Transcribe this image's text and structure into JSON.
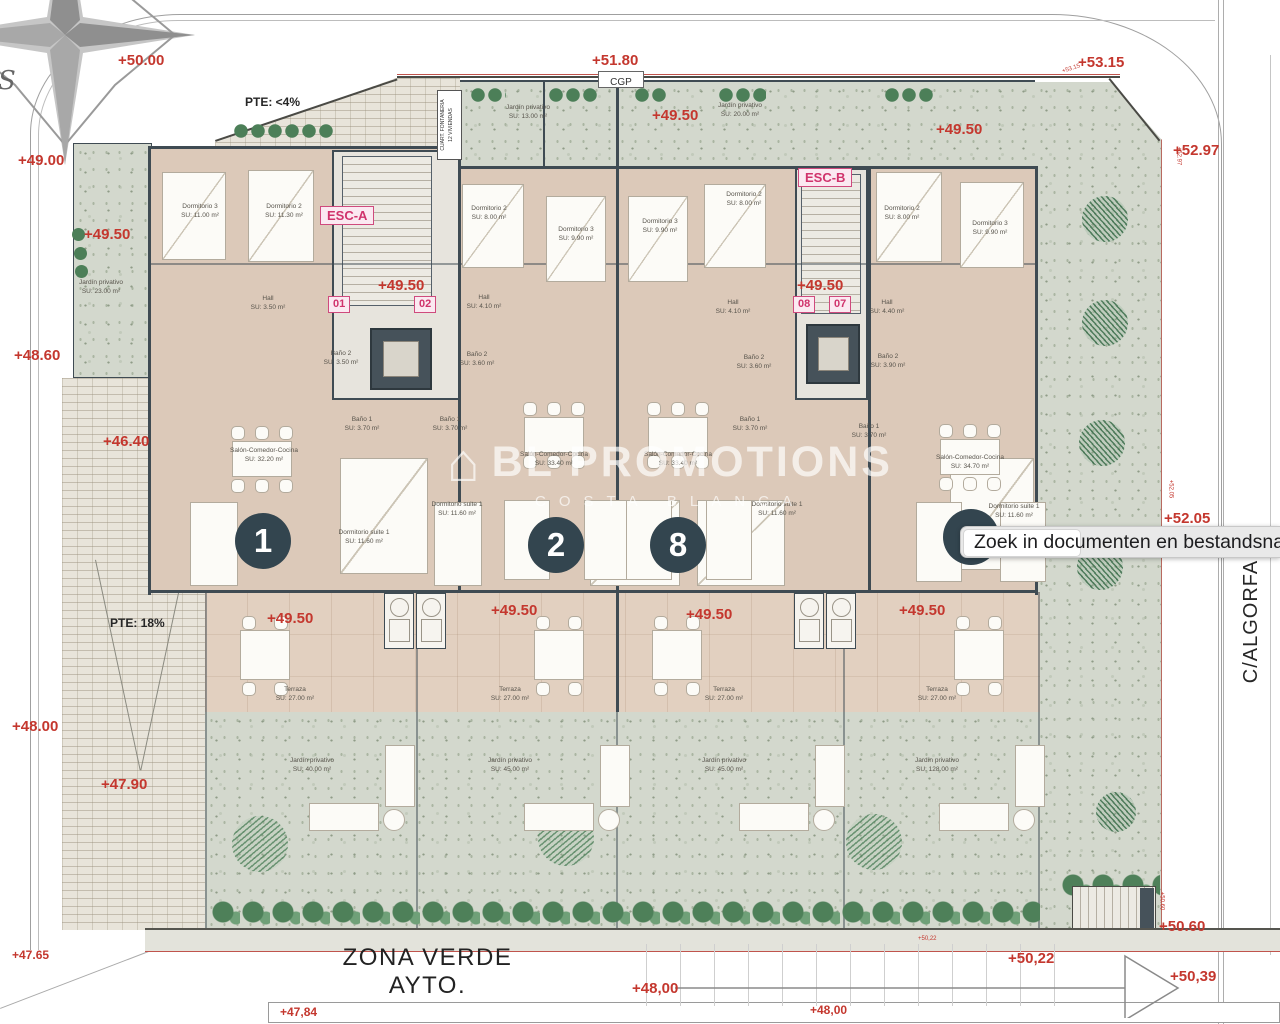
{
  "labels": {
    "compass_s": "S",
    "street": "C/ALGORFA",
    "zona_verde1": "ZONA VERDE",
    "zona_verde2": "AYTO.",
    "cgp": "CGP",
    "pte_top": "PTE: <4%",
    "pte_ramp": "PTE: 18%",
    "fontaneria1": "CUART. FONTANERIA",
    "fontaneria2": "12 VIVIENDAS",
    "esc_a": "ESC-A",
    "esc_b": "ESC-B"
  },
  "unit_tags": [
    "01",
    "02",
    "08",
    "07"
  ],
  "unit_circles": [
    "1",
    "2",
    "8"
  ],
  "watermark": {
    "name": "BL PROMOTIONS",
    "subtitle": "COSTA BLANCA"
  },
  "search": {
    "text": "Zoek in documenten en bestandsnamen"
  },
  "colors": {
    "elevation_red": "#c4372e",
    "magenta": "#d0336c",
    "wall": "#3f4b53",
    "circle": "#33454f"
  },
  "elevations": [
    "+50.00",
    "+51.80",
    "+53.15",
    "+52.97",
    "+49.00",
    "+49.50",
    "+48.60",
    "+46.40",
    "+48.00",
    "+47.90",
    "+47.65",
    "+49.50",
    "+49.50",
    "+49.50",
    "+49.50",
    "+49.50",
    "+49.50",
    "+49.50",
    "+49.50",
    "+49.50",
    "+52.05",
    "+50.60",
    "+50,39",
    "+50,22",
    "+48,00",
    "+48,00",
    "+47,84"
  ],
  "edge_markers": [
    "+53.15",
    "+52.97",
    "+52.05",
    "+50.60",
    "+50,22"
  ],
  "rooms": [
    {
      "name": "Dormitorio 3",
      "area": "SU: 11.00 m²"
    },
    {
      "name": "Dormitorio 2",
      "area": "SU: 11.30 m²"
    },
    {
      "name": "Hall",
      "area": "SU: 3.50 m²"
    },
    {
      "name": "Baño 2",
      "area": "SU: 3.50 m²"
    },
    {
      "name": "Baño 1",
      "area": "SU: 3.70 m²"
    },
    {
      "name": "Salón-Comedor-Cocina",
      "area": "SU: 32.20 m²"
    },
    {
      "name": "Dormitorio suite 1",
      "area": "SU: 11.60 m²"
    },
    {
      "name": "Jardín privativo",
      "area": "SU: 23.00 m²"
    },
    {
      "name": "Dormitorio 2",
      "area": "SU: 8.00 m²"
    },
    {
      "name": "Dormitorio 3",
      "area": "SU: 9.90 m²"
    },
    {
      "name": "Hall",
      "area": "SU: 4.10 m²"
    },
    {
      "name": "Baño 2",
      "area": "SU: 3.60 m²"
    },
    {
      "name": "Baño 1",
      "area": "SU: 3.70 m²"
    },
    {
      "name": "Salón-Comedor-Cocina",
      "area": "SU: 33.40 m²"
    },
    {
      "name": "Dormitorio suite 1",
      "area": "SU: 11.60 m²"
    },
    {
      "name": "Jardín privativo",
      "area": "SU: 13.00 m²"
    },
    {
      "name": "Dormitorio 3",
      "area": "SU: 9.90 m²"
    },
    {
      "name": "Dormitorio 2",
      "area": "SU: 8.00 m²"
    },
    {
      "name": "Hall",
      "area": "SU: 4.10 m²"
    },
    {
      "name": "Baño 2",
      "area": "SU: 3.60 m²"
    },
    {
      "name": "Baño 1",
      "area": "SU: 3.70 m²"
    },
    {
      "name": "Salón-Comedor-Cocina",
      "area": "SU: 33.40 m²"
    },
    {
      "name": "Dormitorio suite 1",
      "area": "SU: 11.60 m²"
    },
    {
      "name": "Jardín privativo",
      "area": "SU: 20.00 m²"
    },
    {
      "name": "Dormitorio 2",
      "area": "SU: 8.00 m²"
    },
    {
      "name": "Dormitorio 3",
      "area": "SU: 9.90 m²"
    },
    {
      "name": "Hall",
      "area": "SU: 4.40 m²"
    },
    {
      "name": "Baño 2",
      "area": "SU: 3.90 m²"
    },
    {
      "name": "Baño 1",
      "area": "SU: 3.70 m²"
    },
    {
      "name": "Salón-Comedor-Cocina",
      "area": "SU: 34.70 m²"
    },
    {
      "name": "Dormitorio suite 1",
      "area": "SU: 11.60 m²"
    },
    {
      "name": "Terraza",
      "area": "SU: 27.00 m²"
    },
    {
      "name": "Terraza",
      "area": "SU: 27.00 m²"
    },
    {
      "name": "Terraza",
      "area": "SU: 27.00 m²"
    },
    {
      "name": "Terraza",
      "area": "SU: 27.00 m²"
    },
    {
      "name": "Jardín privativo",
      "area": "SU: 40.00 m²"
    },
    {
      "name": "Jardín privativo",
      "area": "SU: 45.00 m²"
    },
    {
      "name": "Jardín privativo",
      "area": "SU: 45.00 m²"
    },
    {
      "name": "Jardín privativo",
      "area": "SU: 128.00 m²"
    }
  ]
}
